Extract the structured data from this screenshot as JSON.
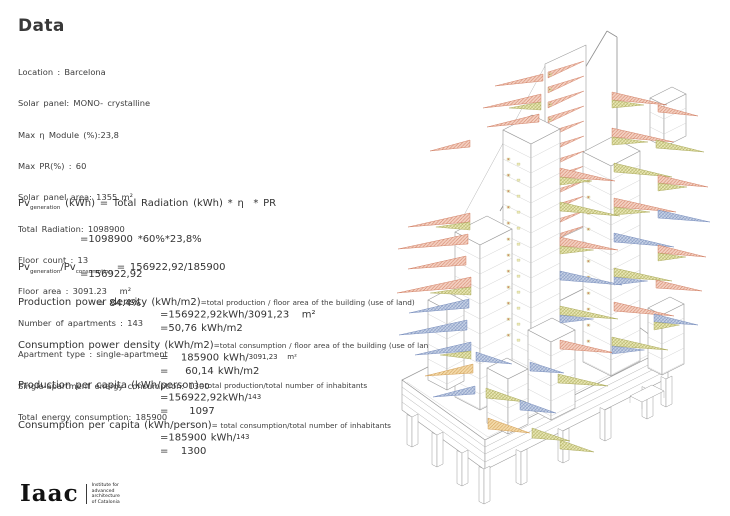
{
  "page": {
    "title": "Data"
  },
  "specs": [
    "Location : Barcelona",
    "Solar panel: MONO- crystalline",
    "Max η Module (%):23,8",
    "Max PR(%) : 60",
    "Solar panel area: 1355 m²",
    "Total Radiation: 1098900",
    "Floor count : 13",
    "Floor area : 3091.23   m²",
    "Number of apartments : 143",
    "Apartment type : single-apartment",
    "Single-apartment energy consumption: 1300",
    "Total energy consumption: 185900"
  ],
  "pv_generation": {
    "prefix": "Pv",
    "sub": "generation",
    "formula": " (kWh) = Total Radiation (kWh) * η  * PR",
    "step1": "=1098900 *60%*23,8%",
    "step2": "=156922,92"
  },
  "pv_ratio": {
    "num_prefix": "Pv",
    "num_sub": "generation",
    "sep": "/",
    "den_prefix": "Pv",
    "den_sub": "consumption",
    "equals": " = 156922,92/185900",
    "step1": "= 84.4%"
  },
  "metrics": [
    {
      "label": "Production power density (kWh/m2)",
      "definition": "=total production / floor area of the building (use of land)",
      "v1": "=156922,92kWh/3091,23   m²",
      "v1_small": "",
      "v2": "=50,76 kWh/m2"
    },
    {
      "label": "Consumption power density (kWh/m2)",
      "definition": "=total consumption / floor area of the building (use of land)",
      "v1": "=   185900 kWh/",
      "v1_small": "3091,23   m²",
      "v2": "=    60,14 kWh/m2"
    },
    {
      "label": "Production per capita (kWh/person)",
      "definition": "=total production/total number of inhabitants",
      "v1": "=156922,92kWh/",
      "v1_small": "143",
      "v2": "=     1097"
    },
    {
      "label": "Consumption per capita (kWh/person)",
      "definition": "= total consumption/total number of inhabitants",
      "v1": "=185900 kWh/",
      "v1_small": "143",
      "v2": "=   1300"
    }
  ],
  "logo": {
    "wordmark": "Iaac",
    "lines": [
      "Institute for",
      "advanced",
      "architecture",
      "of Catalonia"
    ]
  },
  "illustration": {
    "label": "solar-facade-tower-axonometric",
    "colors": {
      "salmon": "#f4d0c1",
      "salmonHatch": "#cf7a5f",
      "olive": "#eae8b6",
      "oliveHatch": "#a6a552",
      "blue": "#c8d3e6",
      "blueHatch": "#7389ba",
      "orange": "#f3daa9",
      "orangeHatch": "#d09a4f",
      "outline": "#9b9b9b"
    }
  }
}
